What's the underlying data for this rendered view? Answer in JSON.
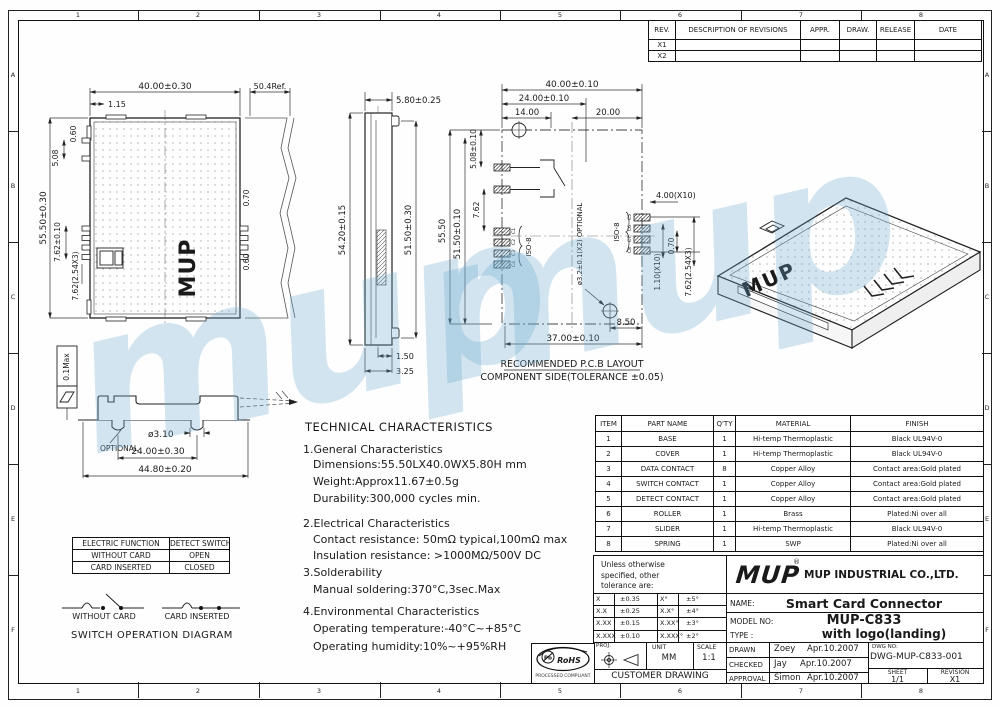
{
  "zones": {
    "top": [
      "1",
      "2",
      "3",
      "4",
      "5",
      "6",
      "7",
      "8"
    ],
    "left": [
      "A",
      "B",
      "C",
      "D",
      "E",
      "F"
    ]
  },
  "watermark": "mup",
  "revisions": {
    "headers": [
      "REV.",
      "DESCRIPTION  OF  REVISIONS",
      "APPR.",
      "DRAW.",
      "RELEASE",
      "DATE"
    ],
    "marks": [
      "X1",
      "X2"
    ]
  },
  "front": {
    "w": "40.00±0.30",
    "ref": "50.4Ref.",
    "offs": "1.15",
    "d060t": "0.60",
    "d508": "5.08",
    "h": "55.50±0.30",
    "d762": "7.62±0.10",
    "d762b": "7.62(2.54X3)",
    "d070": "0.70",
    "d060r": "0.60",
    "logo": "MUP"
  },
  "side": {
    "t": "5.80±0.25",
    "l": "54.20±0.15",
    "r": "51.50±0.30",
    "b1": "1.50",
    "b2": "3.25"
  },
  "pcb": {
    "w": "40.00±0.10",
    "w24": "24.00±0.10",
    "w14": "14.00",
    "w20": "20.00",
    "h": "55.50",
    "h51": "51.50±0.10",
    "d508": "5.08±0.10",
    "d762": "7.62",
    "isoL": "ISO-8",
    "isoR": "ISO-8",
    "padsL": [
      "C1",
      "C2",
      "C3",
      "C4"
    ],
    "padsR": [
      "C5",
      "C6",
      "C7",
      "C8"
    ],
    "p400": "4.00(X10)",
    "p110": "1.10(X10)",
    "p070": "0.70",
    "p762": "7.62(2.54X3)",
    "hole": "ø3.2±0.1(X2) OPTIONAL",
    "b850": "8.50",
    "b37": "37.00±0.10",
    "cap1": "RECOMMENDED P.C.B LAYOUT",
    "cap2": "COMPONENT SIDE(TOLERANCE ±0.05)"
  },
  "bottom": {
    "flat": "0.1Max",
    "hole": "ø3.10",
    "opt": "OPTIONAL",
    "w24": "24.00±0.30",
    "w44": "44.80±0.20"
  },
  "iso": {
    "logo": "MUP"
  },
  "sw": {
    "headers": [
      "ELECTRIC FUNCTION",
      "DETECT SWITCH"
    ],
    "rows": [
      [
        "WITHOUT CARD",
        "OPEN"
      ],
      [
        "CARD INSERTED",
        "CLOSED"
      ]
    ],
    "without": "WITHOUT CARD",
    "inserted": "CARD INSERTED",
    "caption": "SWITCH  OPERATION  DIAGRAM"
  },
  "tech": {
    "lines": [
      "TECHNICAL  CHARACTERISTICS",
      "1.General  Characteristics",
      "Dimensions:55.50LX40.0WX5.80H  mm",
      "Weight:Approx11.67±0.5g",
      "Durability:300,000  cycles  min.",
      "2.Electrical  Characteristics",
      "Contact  resistance: 50mΩ  typical,100mΩ  max",
      "Insulation  resistance: >1000MΩ/500V  DC",
      "3.Solderability",
      "Manual  soldering:370°C,3sec.Max",
      "4.Environmental  Characteristics",
      "Operating  temperature:-40°C~+85°C",
      "Operating  humidity:10%~+95%RH"
    ]
  },
  "parts": {
    "headers": [
      "ITEM",
      "PART NAME",
      "Q'TY",
      "MATERIAL",
      "FINISH"
    ],
    "rows": [
      [
        "1",
        "BASE",
        "1",
        "Hi-temp Thermoplastic",
        "Black UL94V-0"
      ],
      [
        "2",
        "COVER",
        "1",
        "Hi-temp Thermoplastic",
        "Black UL94V-0"
      ],
      [
        "3",
        "DATA CONTACT",
        "8",
        "Copper Alloy",
        "Contact area:Gold plated"
      ],
      [
        "4",
        "SWITCH CONTACT",
        "1",
        "Copper Alloy",
        "Contact area:Gold plated"
      ],
      [
        "5",
        "DETECT CONTACT",
        "1",
        "Copper Alloy",
        "Contact area:Gold plated"
      ],
      [
        "6",
        "ROLLER",
        "1",
        "Brass",
        "Plated:Ni over all"
      ],
      [
        "7",
        "SLIDER",
        "1",
        "Hi-temp Thermoplastic",
        "Black UL94V-0"
      ],
      [
        "8",
        "SPRING",
        "1",
        "SWP",
        "Plated:Ni over all"
      ]
    ]
  },
  "tb": {
    "note": [
      "Unless otherwise",
      "specified, other",
      "tolerance are:"
    ],
    "tol": [
      [
        "X",
        "±0.35",
        "X°",
        "±5°"
      ],
      [
        "X.X",
        "±0.25",
        "X.X°",
        "±4°"
      ],
      [
        "X.XX",
        "±0.15",
        "X.XX°",
        "±3°"
      ],
      [
        "X.XXX",
        "±0.10",
        "X.XXX°",
        "±2°"
      ]
    ],
    "proj_label": "PROJ.",
    "unit_label": "UNIT",
    "unit_value": "MM",
    "scale_label": "SCALE",
    "scale_value": "1:1",
    "customer": "CUSTOMER  DRAWING",
    "logo": "MUP",
    "reg": "®",
    "company": "MUP INDUSTRIAL CO.,LTD.",
    "name_label": "NAME:",
    "name_value": "Smart Card Connector",
    "model_label": "MODEL NO:",
    "model_value": "MUP-C833",
    "type_label": "TYPE :",
    "type_value": "with  logo(landing)",
    "drawn_label": "DRAWN",
    "drawn_name": "Zoey",
    "drawn_date": "Apr.10.2007",
    "checked_label": "CHECKED",
    "checked_name": "Jay",
    "checked_date": "Apr.10.2007",
    "approval_label": "APPROVAL",
    "approval_name": "Simon",
    "approval_date": "Apr.10.2007",
    "dwg_label": "DWG NO:",
    "dwg_value": "DWG-MUP-C833-001",
    "sheet_label": "SHEET",
    "sheet_value": "1/1",
    "rev_label": "REVISION",
    "rev_value": "X1"
  },
  "rohs": {
    "label": "RoHS",
    "pb": "Pb",
    "cap": "PROCESSED COMPLIANT"
  }
}
